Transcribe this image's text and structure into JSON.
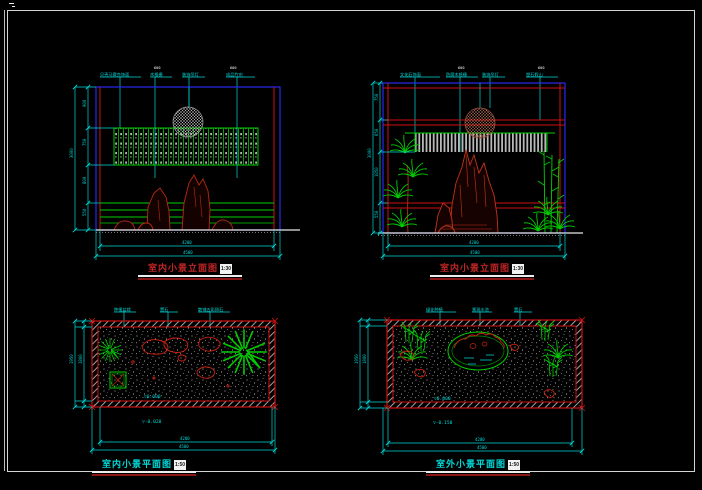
{
  "palette": {
    "border_blue": "#2828f0",
    "line_red": "#d01010",
    "rock_red": "#b52a12",
    "plant_green": "#00cf00",
    "dim_cyan": "#00d9d9",
    "hatch_gray": "#b9b9b9",
    "ground_white": "#e8e8e8"
  },
  "drawings": {
    "elev_left": {
      "title": "室内小景立面图",
      "scale": "1:30",
      "callouts": [
        "贝壳马赛克饰面",
        "木格栅",
        "装饰吊灯",
        "成品竹帘"
      ],
      "top_marks": [
        "600",
        "600"
      ],
      "dims_left": [
        "900",
        "750",
        "800",
        "550"
      ],
      "dim_left_total": "3000",
      "dim_bottom_inner": "4200",
      "dim_bottom_outer": "4500"
    },
    "elev_right": {
      "title": "室内小景立面图",
      "scale": "1:30",
      "callouts": [
        "文化石饰面",
        "防腐木格栅",
        "装饰吊灯",
        "塑石假山"
      ],
      "top_marks": [
        "600",
        "600"
      ],
      "dims_left": [
        "750",
        "650",
        "1050",
        "550"
      ],
      "dim_left_total": "3000",
      "dim_bottom_inner": "4200",
      "dim_bottom_outer": "4500"
    },
    "plan_left": {
      "title": "室内小景平面图",
      "scale": "1:50",
      "callouts": [
        "种植盆栽",
        "置石",
        "散铺五彩卵石"
      ],
      "levels": [
        "▽0.000",
        "▽-0.020"
      ],
      "dim_left": "1800",
      "dim_left_total": "1950",
      "dim_bottom_inner": "4200",
      "dim_bottom_outer": "4500"
    },
    "plan_right": {
      "title": "室外小景平面图",
      "scale": "1:50",
      "callouts": [
        "绿化种植",
        "景观水池",
        "置石"
      ],
      "levels": [
        "▽0.000",
        "▽-0.150"
      ],
      "dim_left": "1800",
      "dim_left_total": "1950",
      "dim_bottom_inner": "4200",
      "dim_bottom_outer": "4500"
    }
  }
}
